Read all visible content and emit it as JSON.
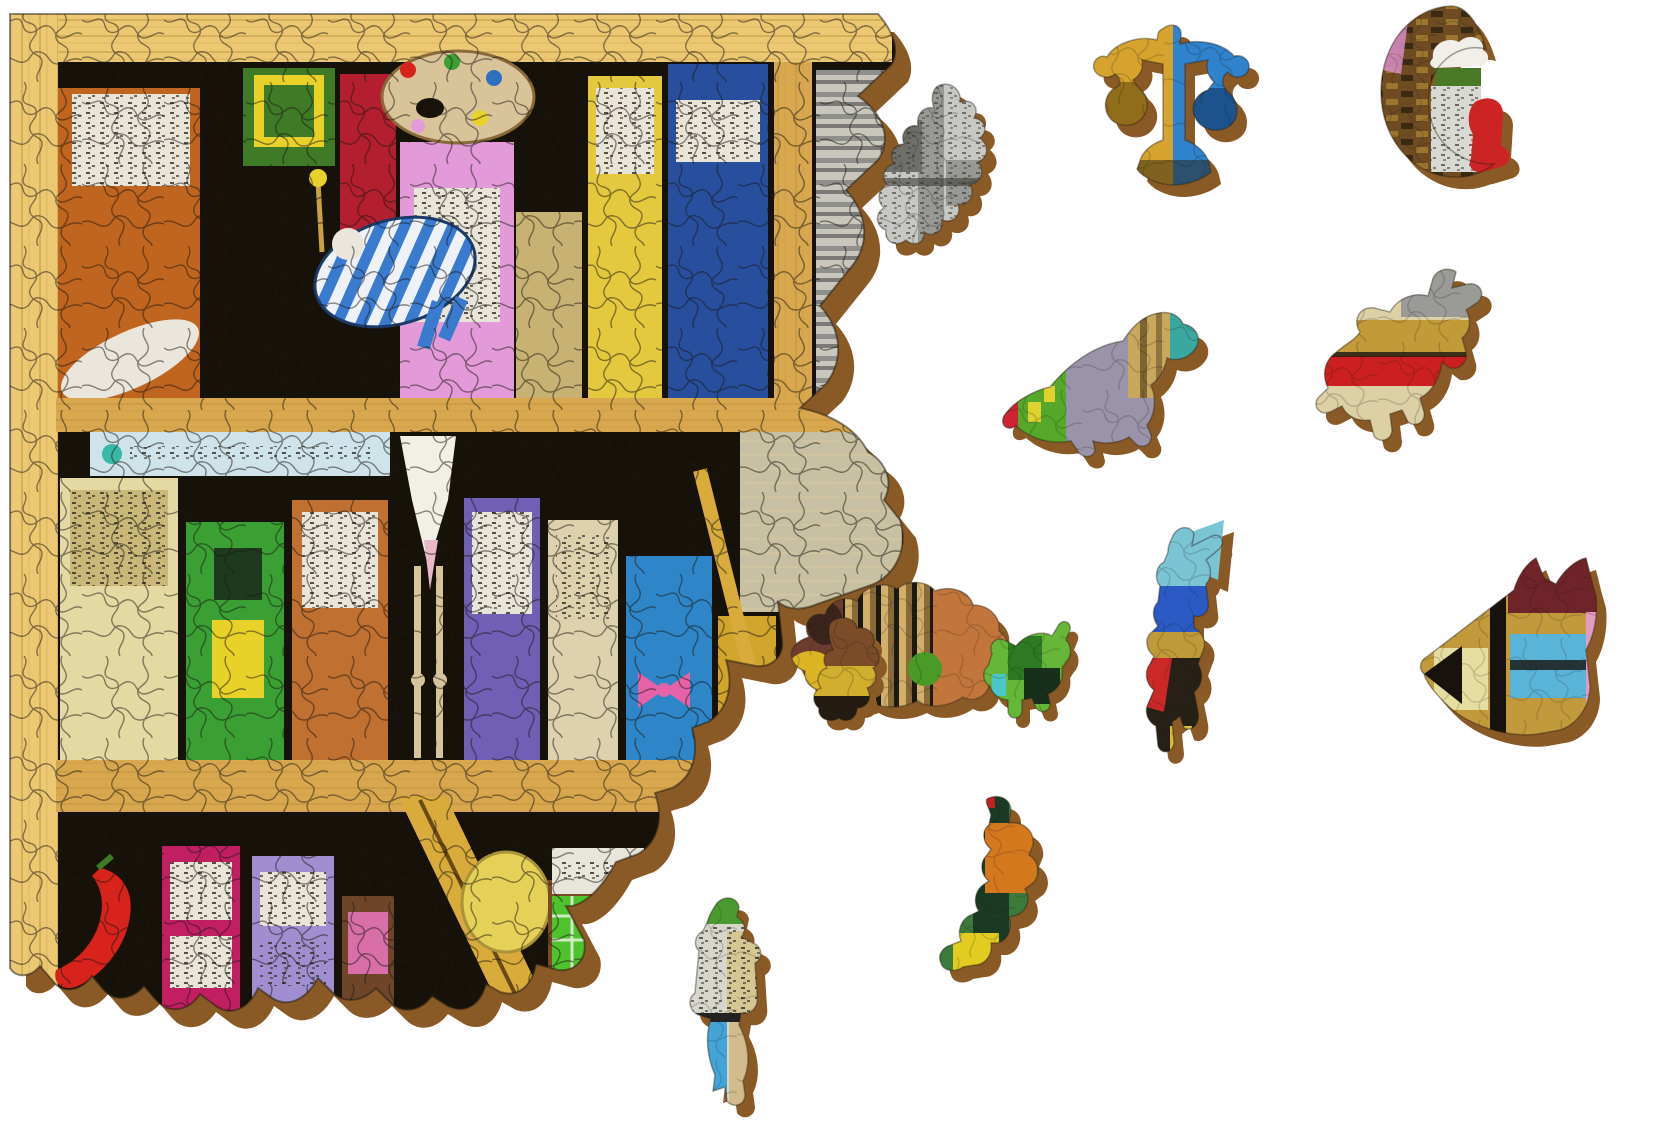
{
  "scene": {
    "description": "Photograph-style view of a partially assembled wooden whimsy jigsaw puzzle showing a fantastical bookshelf illustration; the left half is assembled with ragged unfinished right and bottom edges, and eleven novelty-shaped loose pieces plus one small two-piece cluster lie scattered on a white surface",
    "background_color": "#ffffff",
    "shadow_color": "#8a5a26",
    "cut_line_color": "#1a1510",
    "edge_stroke_color": "#241c12"
  },
  "assembled_section": {
    "description": "Bookshelf artwork: pale wooden frame on left and top, three shelves crowded with whimsical house-shaped books, an artist palette, a sleeper in a blue striped hammock, a long-bearded wizard, a ladder, a chili pepper, an egg and a tiny green shopfront with red door",
    "palette": {
      "frame_wood": "#ecc873",
      "frame_grain": "#b98f3e",
      "shelf_wood": "#d8a74e",
      "shelf_edge": "#f0d088",
      "interior": "#171209",
      "sign_board": "#cfe3ea",
      "sign_dot": "#39b8a8",
      "pages": "#efe6c6",
      "page_line": "#c9bd96",
      "bone": "#eae6dc",
      "beard": "#f2efe6",
      "beard_tip": "#e8b8c8",
      "leg_tan": "#d8c49a",
      "ladder_gold": "#d9ab3a",
      "egg_yellow": "#e5d058",
      "chili_red": "#d8231c",
      "chili_stem": "#3f7a26",
      "shop_green": "#4fc22e",
      "shop_sign": "#e8e5da",
      "door_red": "#d42420",
      "bow_pink": "#e662a8",
      "window_yellow": "#e8d22a",
      "window_dark": "#1e3a1e",
      "hammock_blue": "#3a7bd0",
      "hammock_white": "#eef2f8",
      "palette_tan": "#d9c49a",
      "palette_edge": "#8a6a3a",
      "label_white": "#e9e4d8",
      "label_khaki": "#c9b878",
      "speck_dark": "#3a352c"
    },
    "books": [
      {
        "name": "orange-tome",
        "color": "#c0651f"
      },
      {
        "name": "pink-tome",
        "color": "#e39ad8"
      },
      {
        "name": "khaki-tome",
        "color": "#c8b273"
      },
      {
        "name": "yellow-tome",
        "color": "#e4c93f"
      },
      {
        "name": "navy-tome",
        "color": "#274f9e"
      },
      {
        "name": "green-picture-book",
        "color": "#3f7a26"
      },
      {
        "name": "crimson-tome",
        "color": "#b31f2e"
      },
      {
        "name": "gray-newsprint-stack",
        "color": "#c9c6bd"
      },
      {
        "name": "cream-tall-book",
        "color": "#e4d9a2"
      },
      {
        "name": "green-house-book",
        "color": "#3aa034"
      },
      {
        "name": "orange-house-book",
        "color": "#c07030"
      },
      {
        "name": "purple-book",
        "color": "#6f5fb5"
      },
      {
        "name": "cream-book",
        "color": "#ded2ae"
      },
      {
        "name": "blue-book-with-bow",
        "color": "#2e86c8"
      },
      {
        "name": "mustard-book",
        "color": "#d1a42c"
      },
      {
        "name": "brown-book",
        "color": "#7e4e2a"
      },
      {
        "name": "magenta-book",
        "color": "#c21f63"
      },
      {
        "name": "lavender-book",
        "color": "#9f8fd0"
      },
      {
        "name": "brown-pink-label-book",
        "color": "#6f452a"
      },
      {
        "name": "small-brown-book",
        "color": "#7a4a28"
      }
    ],
    "book_extra": {
      "pink_label": "#d86fa8",
      "gray_band": "#8f8f8c"
    }
  },
  "loose_pieces": [
    {
      "name": "newsprint-head-profile",
      "shape": "human head in profile with spiky headdress, grayscale newsprint texture",
      "colors": {
        "base": "#c7c7c3",
        "mid": "#989894",
        "dark": "#6e6e6a",
        "ink": "#3c3c38"
      }
    },
    {
      "name": "scales-of-justice",
      "shape": "balance scale with two hanging pans",
      "colors": {
        "gold": "#d6a42e",
        "gold_dark": "#7a5a14",
        "blue": "#2f82cc",
        "blue_dark": "#123a6a",
        "base_dark": "#2a2012"
      }
    },
    {
      "name": "crescent-moon-with-sitter",
      "shape": "crescent moon of brick texture with a white-capped tower and a red figure sitting on the tip",
      "colors": {
        "brick": "#6e4b20",
        "brick_dark": "#3a2a12",
        "pink": "#d78cc6",
        "tower": "#d9d9d4",
        "green_band": "#4a7a28",
        "red": "#cc2424",
        "cap": "#f0efe8"
      }
    },
    {
      "name": "dinosaur",
      "shape": "parasaurolophus dinosaur facing right",
      "colors": {
        "body": "#9a93aa",
        "green": "#55a82a",
        "yellow": "#e0d030",
        "head": "#c8a85c",
        "tail_red": "#cc2433",
        "crest_teal": "#3aa8a0"
      }
    },
    {
      "name": "bucking-horse-rider",
      "shape": "bucking horse with rider and pennant",
      "colors": {
        "cream": "#ddd0a4",
        "red_band": "#cc2020",
        "gray": "#9a9a96",
        "gold": "#c29a38",
        "dark": "#2a2218"
      }
    },
    {
      "name": "crouching-boar",
      "shape": "round crouching boar with striped flank",
      "colors": {
        "brown": "#6e3c2e",
        "tan": "#d2b068",
        "tan_dark": "#8a6a3a",
        "orange": "#c3763c",
        "yellow": "#ddb424",
        "green": "#4a9a28",
        "ear": "#3a241c"
      }
    },
    {
      "name": "trotting-horse-green",
      "shape": "small trotting horse of green foliage texture",
      "colors": {
        "green": "#66b63a",
        "green_dark": "#2e7a22",
        "shade": "#17301b",
        "cyan": "#4ac8c8"
      }
    },
    {
      "name": "flag-bearer",
      "shape": "striding figure carrying a pennant flag",
      "colors": {
        "cyan": "#7ac4d4",
        "blue": "#2b5ac4",
        "gold": "#c09a38",
        "red": "#cc2828",
        "dark": "#262016",
        "yellow": "#d8c040"
      }
    },
    {
      "name": "fox-head",
      "shape": "fox head pointing left with two ears",
      "colors": {
        "maroon": "#6e2428",
        "gold": "#c29a3c",
        "black": "#17130c",
        "pale_window": "#e6dda0",
        "cyan_window": "#5ab4d8",
        "pink": "#e29cc4"
      }
    },
    {
      "name": "sea-dragon",
      "shape": "curled sea-dragon with orange wing",
      "colors": {
        "green": "#3c7a3c",
        "green_dark": "#1b3a26",
        "orange": "#d4781e",
        "yellow": "#e2cc22",
        "red": "#c42020"
      }
    },
    {
      "name": "walking-person",
      "shape": "walking person with newsprint jacket and satchel",
      "colors": {
        "cap": "#4a9a30",
        "jacket": "#d6d6cc",
        "book": "#d6c694",
        "blue_leg": "#44a4d8",
        "tan_leg": "#d2bc8c",
        "dark": "#222222"
      }
    },
    {
      "name": "two-piece-cluster",
      "shape": "small cluster of two joined conventional pieces",
      "colors": {
        "brown": "#7c4c28",
        "yellow": "#d2ae2e",
        "dark": "#241c10"
      }
    }
  ]
}
